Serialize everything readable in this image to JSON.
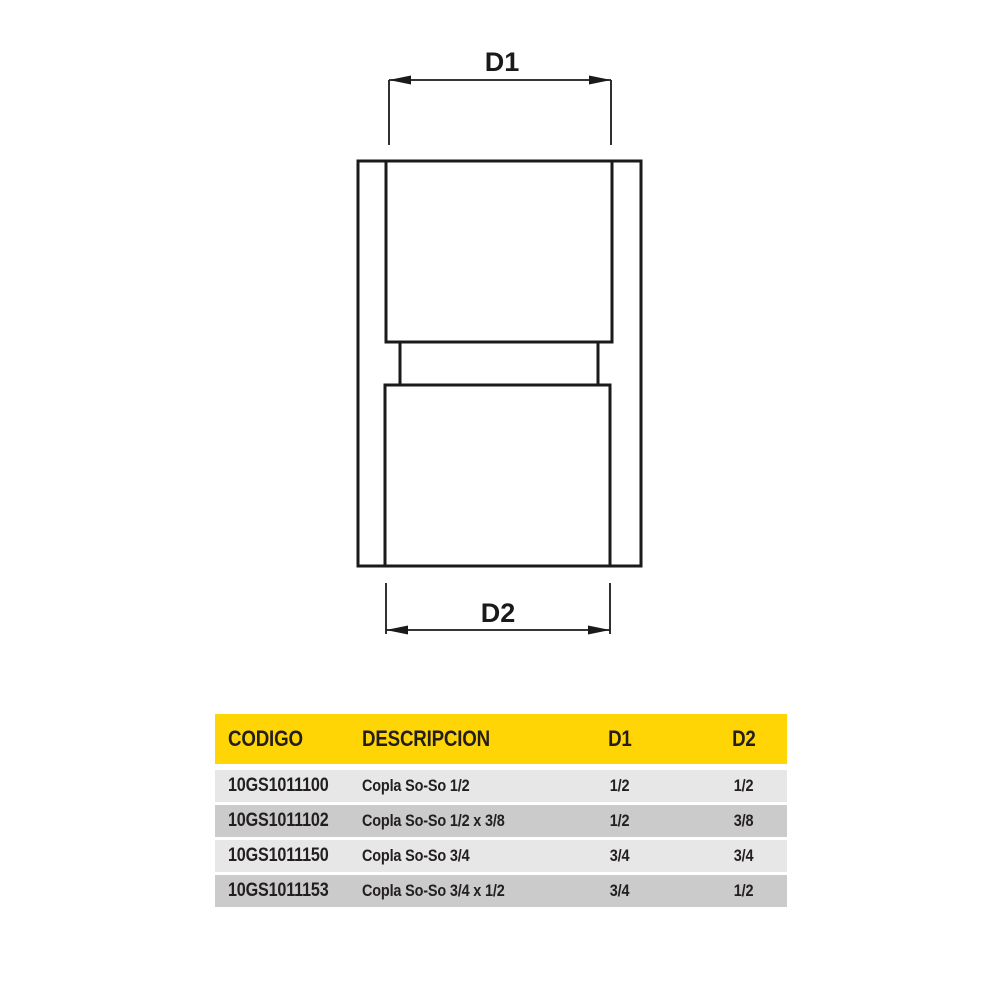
{
  "diagram": {
    "dim_top_label": "D1",
    "dim_bottom_label": "D2"
  },
  "table": {
    "headers": [
      "CODIGO",
      "DESCRIPCION",
      "D1",
      "D2"
    ],
    "rows": [
      {
        "codigo": "10GS1011100",
        "descripcion": "Copla So-So 1/2",
        "d1": "1/2",
        "d2": "1/2"
      },
      {
        "codigo": "10GS1011102",
        "descripcion": "Copla So-So 1/2 x 3/8",
        "d1": "1/2",
        "d2": "3/8"
      },
      {
        "codigo": "10GS1011150",
        "descripcion": "Copla So-So 3/4",
        "d1": "3/4",
        "d2": "3/4"
      },
      {
        "codigo": "10GS1011153",
        "descripcion": "Copla So-So 3/4 x 1/2",
        "d1": "3/4",
        "d2": "1/2"
      }
    ]
  },
  "colors": {
    "header_bg": "#FFD505",
    "row_light": "#E7E7E7",
    "row_dark": "#CBCBCB",
    "text_color": "#231F20",
    "line_color": "#1A1A1A"
  }
}
